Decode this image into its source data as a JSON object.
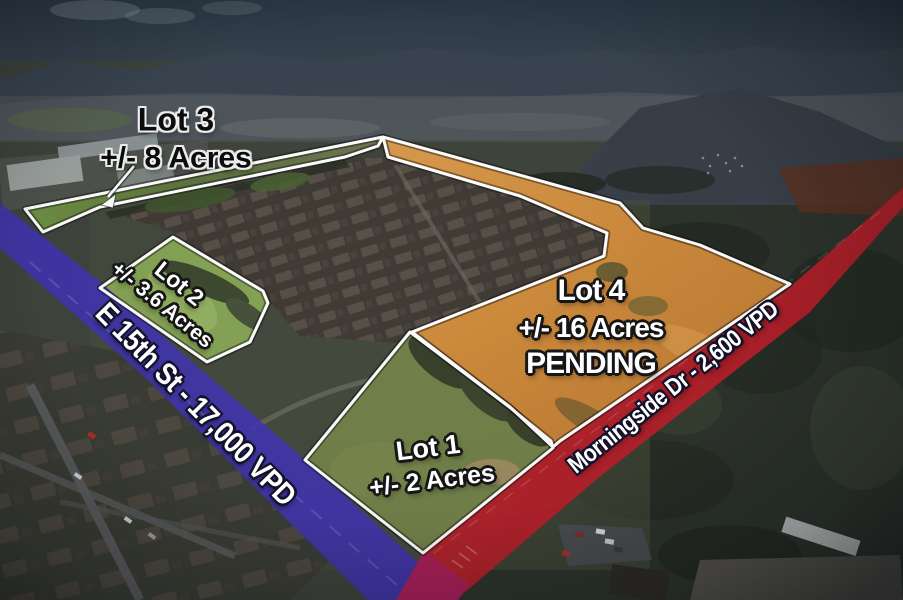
{
  "lots": [
    {
      "name": "Lot 1",
      "acreage": "+/- 2 Acres",
      "status": ""
    },
    {
      "name": "Lot 2",
      "acreage": "+/- 3.6 Acres",
      "status": ""
    },
    {
      "name": "Lot 3",
      "acreage": "+/- 8 Acres",
      "status": ""
    },
    {
      "name": "Lot 4",
      "acreage": "+/- 16 Acres",
      "status": "PENDING"
    }
  ],
  "roads": [
    {
      "name": "E 15th St - 17,000 VPD",
      "band_color": "#4134b4"
    },
    {
      "name": "Morningside Dr - 2,600 VPD",
      "band_color": "#bc1f2a"
    }
  ],
  "colors": {
    "lot_outline": "#ffffff",
    "lot4_fill": "#cd8a3c",
    "intersection_overlap": "#a8205f"
  }
}
